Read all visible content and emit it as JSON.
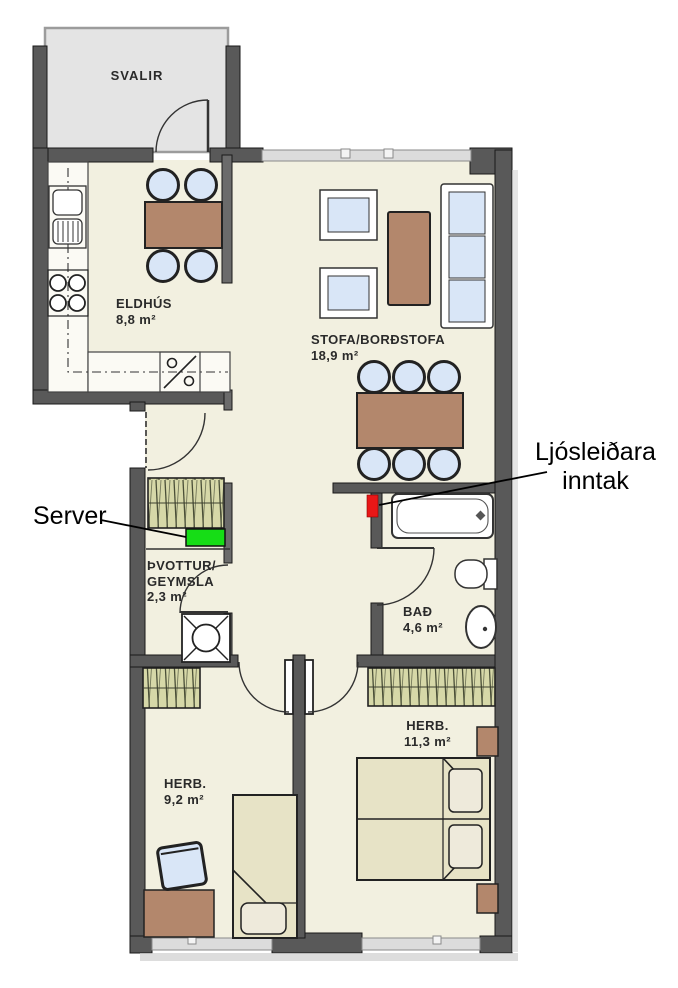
{
  "rooms": {
    "balcony": {
      "name": "SVALIR"
    },
    "kitchen": {
      "name": "ELDHÚS",
      "area": "8,8 m²"
    },
    "living_dining": {
      "name": "STOFA/BORÐSTOFA",
      "area": "18,9 m²"
    },
    "laundry_storage": {
      "name_line1": "ÞVOTTUR/",
      "name_line2": "GEYMSLA",
      "area": "2,3 m²"
    },
    "bathroom": {
      "name": "BAÐ",
      "area": "4,6 m²"
    },
    "bedroom_large": {
      "name": "HERB.",
      "area": "11,3 m²"
    },
    "bedroom_small": {
      "name": "HERB.",
      "area": "9,2 m²"
    }
  },
  "annotations": {
    "server": {
      "label": "Server",
      "marker_color": "#16dd16"
    },
    "fiber_inlet": {
      "label_line1": "Ljósleiðara",
      "label_line2": "inntak",
      "marker_color": "#e81717"
    }
  },
  "palette": {
    "wall": "#595959",
    "floor": "#f2f0e0",
    "balcony_floor": "#e4e4e4",
    "furniture_wood": "#b3876c",
    "upholstery_blue": "#d9e6f7",
    "bed_beige": "#e7e3c6",
    "wardrobe_olive": "#d6d8a8"
  }
}
